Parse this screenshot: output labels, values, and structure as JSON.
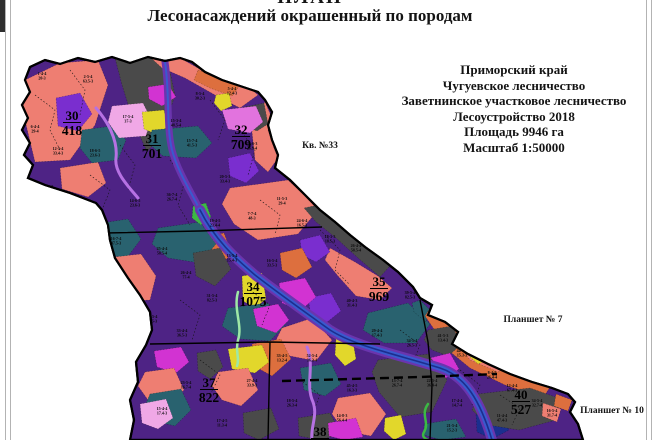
{
  "page": {
    "title_top": "ПЛАН",
    "title_main": "Лесонасаждений окрашенный по породам"
  },
  "info_block": {
    "lines": [
      "Приморский край",
      "Чугуевское лесничество",
      "Заветнинское участковое лесничество",
      "Лесоустройство 2018",
      "Площадь 9946 га",
      "Масштаб 1:50000"
    ]
  },
  "map": {
    "palette": {
      "purple": "#4e2385",
      "salmon": "#ee7e72",
      "orange": "#dd6f3e",
      "gray": "#4a4a4a",
      "teal": "#29626f",
      "magenta": "#d233d2",
      "pinkm": "#e273de",
      "pink": "#f0a8e6",
      "yellow": "#e2d72b",
      "violet": "#7a2ecf",
      "blue": "#3a5ace",
      "navy": "#1b2f8f",
      "corridor": "#6a35ae",
      "lavender": "#b671e3",
      "ltgreen": "#9ee8a6",
      "green": "#3cb944"
    },
    "outline": "30,67 45,60 60,64 78,58 95,62 112,57 130,63 148,57 165,61 180,58 192,62 205,72 222,80 240,86 252,90 258,92 265,100 272,112 268,125 272,140 278,155 275,168 290,180 305,195 320,210 335,222 350,235 365,247 383,260 398,272 413,287 420,298 432,305 428,315 445,322 458,332 452,344 468,354 488,364 510,374 532,382 552,388 568,394 575,402 570,412 578,424 583,440 130,440 134,420 130,400 138,382 136,362 146,345 152,330 150,312 140,295 128,278 115,258 110,240 108,225 102,210 96,203 70,193 45,185 28,178 33,165 24,155 30,143 22,130 28,118 22,105 30,92 25,80",
    "patches": [
      {
        "c": "salmon",
        "p": "25,80 60,63 98,60 108,85 95,125 70,160 35,162 22,108"
      },
      {
        "c": "salmon",
        "p": "28,178 96,203 108,228 85,248 55,235 38,205"
      },
      {
        "c": "salmon",
        "p": "60,168 98,162 106,183 88,197 62,189"
      },
      {
        "c": "gray",
        "p": "115,58 150,57 168,62 175,95 162,135 147,152 133,120 122,85"
      },
      {
        "c": "salmon",
        "p": "150,57 180,58 205,72 230,84 252,90 258,95 240,108 215,95 185,78 162,68"
      },
      {
        "c": "orange",
        "p": "198,70 222,78 240,85 232,96 210,88 194,80"
      },
      {
        "c": "salmon",
        "p": "265,102 272,118 268,130 274,148 278,158 268,172 255,160 252,132 256,112"
      },
      {
        "c": "violet",
        "p": "56,98 80,93 92,114 78,131 58,126"
      },
      {
        "c": "teal",
        "p": "82,130 112,126 126,140 118,160 92,163 80,148"
      },
      {
        "c": "pink",
        "p": "112,106 143,103 151,119 146,136 119,138 108,122"
      },
      {
        "c": "yellow",
        "p": "142,112 164,110 168,127 156,134 144,129"
      },
      {
        "c": "magenta",
        "p": "148,87 168,84 176,97 162,106 149,99"
      },
      {
        "c": "yellow",
        "p": "216,95 229,93 232,106 221,111 214,103"
      },
      {
        "c": "teal",
        "p": "152,130 198,126 212,143 196,158 163,156 148,143"
      },
      {
        "c": "gray",
        "p": "240,108 264,103 268,124 257,131 244,126"
      },
      {
        "c": "pinkm",
        "p": "222,110 256,106 263,122 250,133 228,129"
      },
      {
        "c": "violet",
        "p": "228,158 250,153 259,171 246,183 230,176"
      },
      {
        "c": "teal",
        "p": "95,224 128,219 141,239 126,259 100,252 88,238"
      },
      {
        "c": "salmon",
        "p": "114,257 141,254 156,276 150,300 129,301 118,280"
      },
      {
        "c": "orange",
        "p": "198,238 224,233 232,254 216,268 199,261"
      },
      {
        "c": "teal",
        "p": "158,228 200,222 216,244 200,263 168,258 152,244"
      },
      {
        "c": "salmon",
        "p": "230,188 288,180 305,196 318,210 298,234 258,240 234,224 222,204"
      },
      {
        "c": "gray",
        "p": "193,253 220,248 231,269 215,286 196,276"
      },
      {
        "c": "green",
        "p": "193,206 206,203 211,217 201,225 192,218"
      },
      {
        "c": "gray",
        "p": "318,205 332,213 352,233 375,253 390,266 380,277 358,258 336,238 316,222 304,208"
      },
      {
        "c": "salmon",
        "p": "330,248 355,262 378,276 392,288 380,300 356,296 338,276 325,260"
      },
      {
        "c": "violet",
        "p": "300,240 320,235 330,252 316,262 302,255"
      },
      {
        "c": "orange",
        "p": "280,253 302,248 312,267 296,278 282,270"
      },
      {
        "c": "yellow",
        "p": "242,276 262,273 266,299 255,308 243,301"
      },
      {
        "c": "teal",
        "p": "228,308 268,303 286,324 270,341 240,339 222,326"
      },
      {
        "c": "magenta",
        "p": "253,309 278,304 289,320 276,333 257,326"
      },
      {
        "c": "magenta",
        "p": "118,298 140,293 149,309 136,321 121,315"
      },
      {
        "c": "violet",
        "p": "308,298 331,293 341,311 326,323 311,316"
      },
      {
        "c": "magenta",
        "p": "279,283 305,278 316,297 300,311 282,303"
      },
      {
        "c": "teal",
        "p": "368,313 408,303 430,324 416,343 384,343 363,330"
      },
      {
        "c": "salmon",
        "p": "282,328 312,318 332,340 316,361 290,356 275,342"
      },
      {
        "c": "yellow",
        "p": "336,339 352,336 356,359 345,366 335,355"
      },
      {
        "c": "teal",
        "p": "420,300 430,310 426,322 414,312 412,303"
      },
      {
        "c": "orange",
        "p": "432,305 445,320 458,331 452,342 468,353 488,363 510,373 532,381 550,387 543,398 505,385 470,368 448,350 436,332 425,316"
      },
      {
        "c": "salmon",
        "p": "470,330 505,342 518,360 498,372 470,360 458,344"
      },
      {
        "c": "gray",
        "p": "428,330 452,326 462,344 448,356 432,350 424,340"
      },
      {
        "c": "yellow",
        "p": "472,349 485,346 488,360 478,364 470,357"
      },
      {
        "c": "magenta",
        "p": "430,358 450,353 459,369 446,378 432,372"
      },
      {
        "c": "gray",
        "p": "378,360 428,354 447,380 432,412 400,417 379,392 372,372"
      },
      {
        "c": "teal",
        "p": "300,368 331,363 341,384 325,396 304,390"
      },
      {
        "c": "orange",
        "p": "252,344 281,339 291,359 272,376 254,366"
      },
      {
        "c": "yellow",
        "p": "228,349 262,345 269,362 255,373 232,369"
      },
      {
        "c": "magenta",
        "p": "154,351 181,347 189,362 176,373 157,367"
      },
      {
        "c": "salmon",
        "p": "145,372 174,368 184,390 168,406 148,400 138,386"
      },
      {
        "c": "teal",
        "p": "150,394 181,389 191,410 175,426 154,421 144,408"
      },
      {
        "c": "pink",
        "p": "140,404 166,399 173,418 158,429 142,423"
      },
      {
        "c": "gray",
        "p": "197,353 216,350 223,367 210,379 198,371"
      },
      {
        "c": "salmon",
        "p": "218,372 248,368 258,390 241,406 222,400 212,386"
      },
      {
        "c": "gray",
        "p": "243,413 271,408 279,429 259,440 244,433"
      },
      {
        "c": "gray",
        "p": "298,418 330,413 341,434 320,440 299,436"
      },
      {
        "c": "salmon",
        "p": "338,398 370,393 386,414 371,436 344,431 332,414"
      },
      {
        "c": "magenta",
        "p": "328,423 356,418 363,437 344,440 329,436"
      },
      {
        "c": "yellow",
        "p": "385,418 401,415 406,434 394,440 384,431"
      },
      {
        "c": "navy",
        "p": "476,414 500,409 509,430 492,439 477,432"
      },
      {
        "c": "teal",
        "p": "424,424 456,419 466,437 441,440 424,435"
      },
      {
        "c": "gray",
        "p": "478,394 530,388 561,399 556,420 519,430 488,425 472,410"
      },
      {
        "c": "orange",
        "p": "556,394 572,400 568,411 554,406"
      },
      {
        "c": "salmon",
        "p": "543,403 561,409 557,422 542,416"
      }
    ],
    "rivers": [
      {
        "d": "M165,62 C170,95 166,125 172,150 C178,172 190,190 200,210",
        "strokes": [
          [
            "corridor",
            7
          ],
          [
            "blue",
            2
          ]
        ]
      },
      {
        "d": "M200,210 C215,240 235,258 255,275 C278,293 305,312 330,330 C355,346 395,354 440,368 C465,376 480,400 492,440",
        "strokes": [
          [
            "corridor",
            10
          ],
          [
            "blue",
            5.5
          ],
          [
            "navy",
            1.6
          ]
        ]
      }
    ],
    "roads": [
      {
        "d": "M96,108 C108,122 118,140 116,158 C114,172 128,186 138,198",
        "c": "lavender",
        "w": 3
      },
      {
        "d": "M307,347 C315,365 305,385 313,402 C318,416 310,428 312,440",
        "c": "lavender",
        "w": 3
      },
      {
        "d": "M238,292 C233,310 243,325 238,340 C235,352 240,358 237,366",
        "c": "ltgreen",
        "w": 2.5
      },
      {
        "d": "M428,404 C420,415 430,422 424,432 C421,437 426,439 428,440",
        "c": "green",
        "w": 2.5
      }
    ],
    "boundaries": [
      {
        "p": "105,233 200,231 322,227",
        "w": 1.4
      },
      {
        "p": "150,344 270,342 380,344",
        "w": 1.4
      },
      {
        "p": "270,342 268,440",
        "w": 1.4
      },
      {
        "p": "420,300 428,342 432,385 430,440",
        "w": 1.4
      },
      {
        "p": "30,66 26,46",
        "w": 1.2
      },
      {
        "p": "258,92 292,88",
        "w": 1.2
      },
      {
        "p": "282,381 420,377 497,374",
        "w": 2.4,
        "dash": "9,5"
      }
    ],
    "dotted": [
      "35,95 55,110 50,130 60,150",
      "70,70 85,90 80,115",
      "120,145 135,165 128,190",
      "170,160 185,180 178,205 190,225",
      "240,130 255,150 248,175",
      "210,100 225,120 218,140",
      "260,200 280,215 275,235",
      "320,230 340,250 335,270 350,285",
      "250,290 270,305 262,325",
      "180,300 200,315 192,340",
      "400,330 420,345 412,365",
      "460,370 480,385 472,405",
      "300,380 320,395 312,415",
      "200,360 220,375 210,395",
      "500,395 520,408 512,425",
      "90,175 110,190 102,210"
    ],
    "quarters": [
      {
        "number": "30",
        "area": "418",
        "x": 72,
        "y": 120
      },
      {
        "number": "31",
        "area": "701",
        "x": 152,
        "y": 143
      },
      {
        "number": "32",
        "area": "709",
        "x": 241,
        "y": 134
      },
      {
        "number": "34",
        "area": "1075",
        "x": 253,
        "y": 291
      },
      {
        "number": "35",
        "area": "969",
        "x": 379,
        "y": 286
      },
      {
        "number": "37",
        "area": "822",
        "x": 209,
        "y": 387
      },
      {
        "number": "38",
        "area": "",
        "x": 320,
        "y": 436
      },
      {
        "number": "40",
        "area": "527",
        "x": 521,
        "y": 399
      }
    ],
    "annotations": [
      {
        "text": "Кв. №33",
        "x": 320,
        "y": 148
      },
      {
        "text": "Планшет № 7",
        "x": 533,
        "y": 322
      },
      {
        "text": "Планшет № 10",
        "x": 612,
        "y": 413
      }
    ],
    "parcel_labels": [
      {
        "x": 42,
        "y": 75,
        "a": "1-4-4",
        "b": "20-3"
      },
      {
        "x": 88,
        "y": 78,
        "a": "2-5-4",
        "b": "63.5-3"
      },
      {
        "x": 35,
        "y": 128,
        "a": "6-4-4",
        "b": "29-4"
      },
      {
        "x": 58,
        "y": 150,
        "a": "12-5-4",
        "b": "33.4-3"
      },
      {
        "x": 48,
        "y": 188,
        "a": "15-4-5",
        "b": "27.6-3"
      },
      {
        "x": 75,
        "y": 220,
        "a": "34-4-5",
        "b": "44.5-3"
      },
      {
        "x": 116,
        "y": 240,
        "a": "16-7-4",
        "b": "47.5-3"
      },
      {
        "x": 95,
        "y": 152,
        "a": "18-6-5",
        "b": "23.6-3"
      },
      {
        "x": 128,
        "y": 118,
        "a": "17-5-4",
        "b": "37-3"
      },
      {
        "x": 176,
        "y": 122,
        "a": "15-3-4",
        "b": "48.5-4"
      },
      {
        "x": 192,
        "y": 142,
        "a": "15-7-4",
        "b": "41.5-3"
      },
      {
        "x": 200,
        "y": 95,
        "a": "8-5-4",
        "b": "30.2-3"
      },
      {
        "x": 232,
        "y": 90,
        "a": "5-4-4",
        "b": "12.4-3"
      },
      {
        "x": 252,
        "y": 145,
        "a": "22-6-3",
        "b": "26.9-4"
      },
      {
        "x": 225,
        "y": 178,
        "a": "20-5-3",
        "b": "33.4-3"
      },
      {
        "x": 172,
        "y": 196,
        "a": "36-7-4",
        "b": "26.7-4"
      },
      {
        "x": 135,
        "y": 202,
        "a": "14-6-5",
        "b": "23.6-3"
      },
      {
        "x": 215,
        "y": 222,
        "a": "19-4-5",
        "b": "23.4-4"
      },
      {
        "x": 252,
        "y": 215,
        "a": "7-7-4",
        "b": "48-3"
      },
      {
        "x": 282,
        "y": 200,
        "a": "11-5-3",
        "b": "29-4"
      },
      {
        "x": 302,
        "y": 222,
        "a": "24-6-4",
        "b": "16.5-3"
      },
      {
        "x": 162,
        "y": 250,
        "a": "25-4-4",
        "b": "58.5-4"
      },
      {
        "x": 186,
        "y": 274,
        "a": "26-4-4",
        "b": "77-4"
      },
      {
        "x": 212,
        "y": 297,
        "a": "31-5-4",
        "b": "82.5-3"
      },
      {
        "x": 152,
        "y": 318,
        "a": "28-5-4",
        "b": "56.5-3"
      },
      {
        "x": 182,
        "y": 332,
        "a": "33-4-4",
        "b": "36.5-3"
      },
      {
        "x": 232,
        "y": 257,
        "a": "13-5-4",
        "b": "15.4-3"
      },
      {
        "x": 272,
        "y": 262,
        "a": "16-5-4",
        "b": "33.5-3"
      },
      {
        "x": 330,
        "y": 238,
        "a": "18-3-3",
        "b": "18.5-3"
      },
      {
        "x": 356,
        "y": 247,
        "a": "26-4-4",
        "b": "58.5-4"
      },
      {
        "x": 390,
        "y": 254,
        "a": "37-7-4",
        "b": "44.3-3"
      },
      {
        "x": 410,
        "y": 294,
        "a": "39-5-4",
        "b": "82.5-3"
      },
      {
        "x": 352,
        "y": 302,
        "a": "40-4-3",
        "b": "31.4-3"
      },
      {
        "x": 377,
        "y": 332,
        "a": "29-4-4",
        "b": "17.4-3"
      },
      {
        "x": 412,
        "y": 342,
        "a": "34-5-4",
        "b": "26.5-3"
      },
      {
        "x": 443,
        "y": 337,
        "a": "41-5-3",
        "b": "13.4-3"
      },
      {
        "x": 462,
        "y": 352,
        "a": "44-4-4",
        "b": "15.3-3"
      },
      {
        "x": 492,
        "y": 374,
        "a": "8-4-5",
        "b": "26.4-4"
      },
      {
        "x": 512,
        "y": 387,
        "a": "12-4-4",
        "b": "67.4-3"
      },
      {
        "x": 537,
        "y": 402,
        "a": "34-5-4",
        "b": "32.7-4"
      },
      {
        "x": 457,
        "y": 402,
        "a": "17-4-4",
        "b": "14.7-4"
      },
      {
        "x": 432,
        "y": 382,
        "a": "22-5-4",
        "b": "36.4-4"
      },
      {
        "x": 397,
        "y": 382,
        "a": "13-7-4",
        "b": "26.7-4"
      },
      {
        "x": 352,
        "y": 387,
        "a": "45-4-5",
        "b": "16.3-3"
      },
      {
        "x": 312,
        "y": 357,
        "a": "52-5-4",
        "b": "36.3-4"
      },
      {
        "x": 282,
        "y": 357,
        "a": "33-4-5",
        "b": "13.2-4"
      },
      {
        "x": 252,
        "y": 382,
        "a": "27-4-4",
        "b": "33.9-3"
      },
      {
        "x": 186,
        "y": 384,
        "a": "23-5-4",
        "b": "16.7-4"
      },
      {
        "x": 162,
        "y": 410,
        "a": "15-4-4",
        "b": "17.4-3"
      },
      {
        "x": 222,
        "y": 422,
        "a": "17-4-5",
        "b": "11.3-4"
      },
      {
        "x": 292,
        "y": 402,
        "a": "18-5-4",
        "b": "26.3-4"
      },
      {
        "x": 342,
        "y": 417,
        "a": "14-8-3",
        "b": "56.4-4"
      },
      {
        "x": 452,
        "y": 427,
        "a": "21-5-4",
        "b": "15.2-3"
      },
      {
        "x": 502,
        "y": 417,
        "a": "11-4-4",
        "b": "47.4-3"
      },
      {
        "x": 552,
        "y": 412,
        "a": "16-5-4",
        "b": "31.7-4"
      }
    ]
  }
}
